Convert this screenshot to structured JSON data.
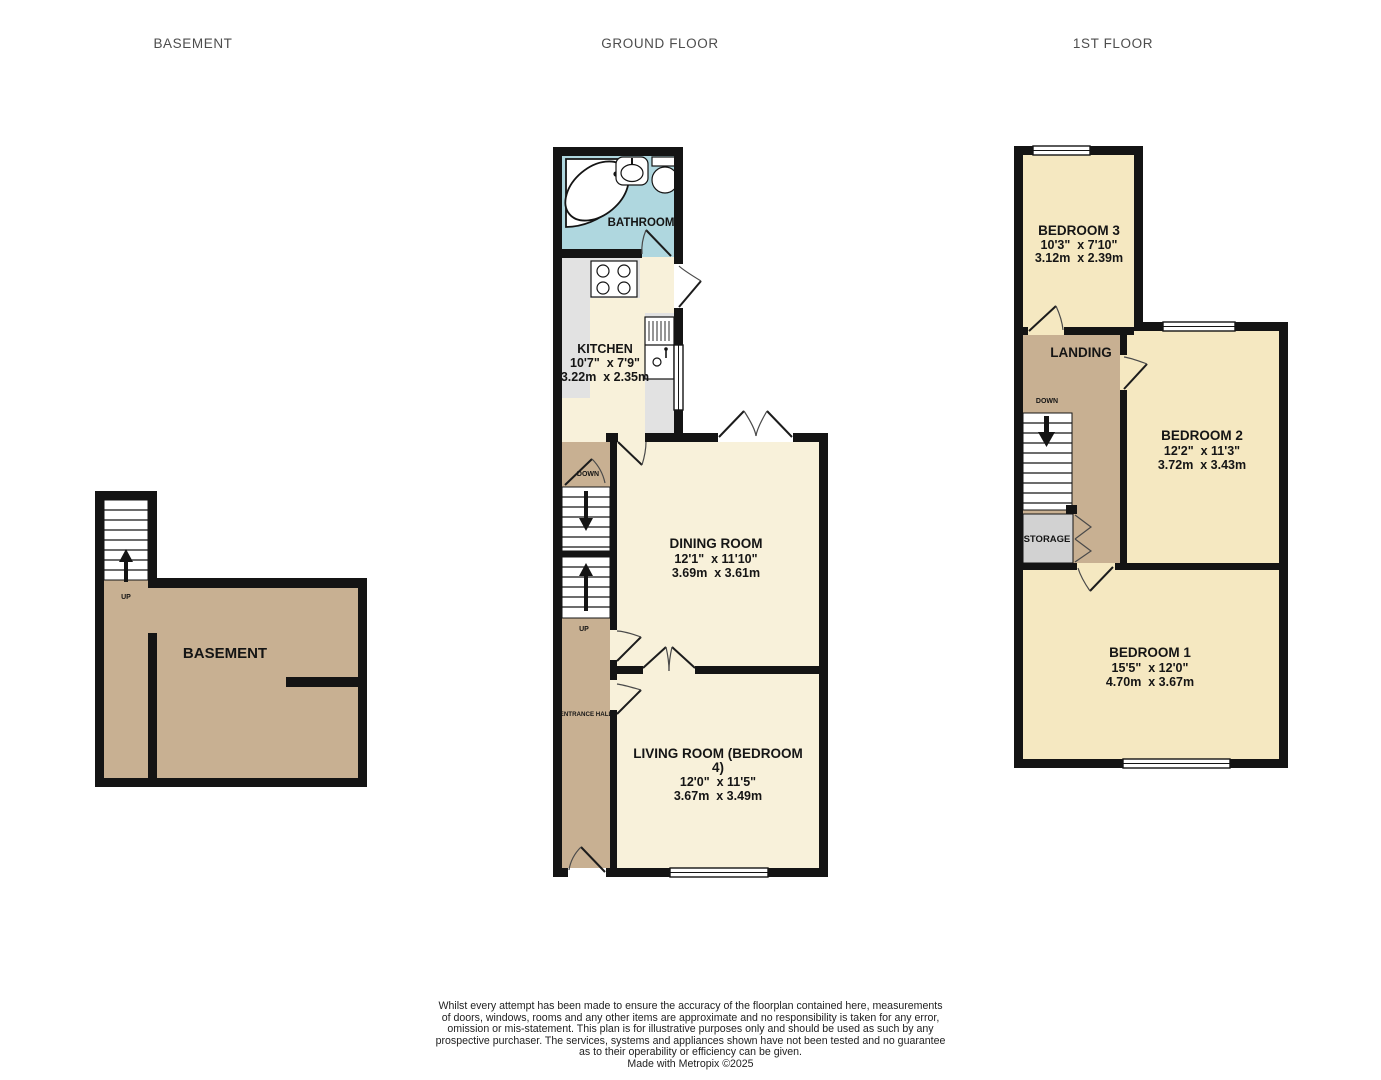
{
  "titles": {
    "basement": "BASEMENT",
    "ground": "GROUND FLOOR",
    "first": "1ST FLOOR"
  },
  "palette": {
    "wall": "#141414",
    "ground_floor_cream": "#f8f1da",
    "bedroom_yellow": "#f5e8c1",
    "hall_landing_tan": "#c8b092",
    "bathroom_blue": "#afd7df",
    "storage_gray": "#d2d2d2",
    "counter_gray": "#e2e2e2",
    "title_gray": "#4d4d4d"
  },
  "basement": {
    "room_label": "BASEMENT",
    "up_label": "UP"
  },
  "ground": {
    "bathroom": {
      "label": "BATHROOM"
    },
    "kitchen": {
      "name": "KITCHEN",
      "imperial": "10'7\"  x 7'9\"",
      "metric": "3.22m  x 2.35m"
    },
    "dining": {
      "name": "DINING ROOM",
      "imperial": "12'1\"  x 11'10\"",
      "metric": "3.69m  x 3.61m"
    },
    "living": {
      "name_line1": "LIVING ROOM (BEDROOM",
      "name_line2": "4)",
      "imperial": "12'0\"  x 11'5\"",
      "metric": "3.67m  x 3.49m"
    },
    "entrance_hall_label": "ENTRANCE HALL",
    "stairs": {
      "down_label": "DOWN",
      "up_label": "UP"
    }
  },
  "first": {
    "bedroom3": {
      "name": "BEDROOM 3",
      "imperial": "10'3\"  x 7'10\"",
      "metric": "3.12m  x 2.39m"
    },
    "bedroom2": {
      "name": "BEDROOM 2",
      "imperial": "12'2\"  x 11'3\"",
      "metric": "3.72m  x 3.43m"
    },
    "bedroom1": {
      "name": "BEDROOM 1",
      "imperial": "15'5\"  x 12'0\"",
      "metric": "4.70m  x 3.67m"
    },
    "landing_label": "LANDING",
    "storage_label": "STORAGE",
    "down_label": "DOWN"
  },
  "footer": {
    "lines": [
      "Whilst every attempt has been made to ensure the accuracy of the floorplan contained here, measurements",
      "of doors, windows, rooms and any other items are approximate and no responsibility is taken for any error,",
      "omission or mis-statement. This plan is for illustrative purposes only and should be used as such by any",
      "prospective purchaser. The services, systems and appliances shown have not been tested and no guarantee",
      "as to their operability or efficiency can be given."
    ],
    "credit": "Made with Metropix ©2025"
  }
}
